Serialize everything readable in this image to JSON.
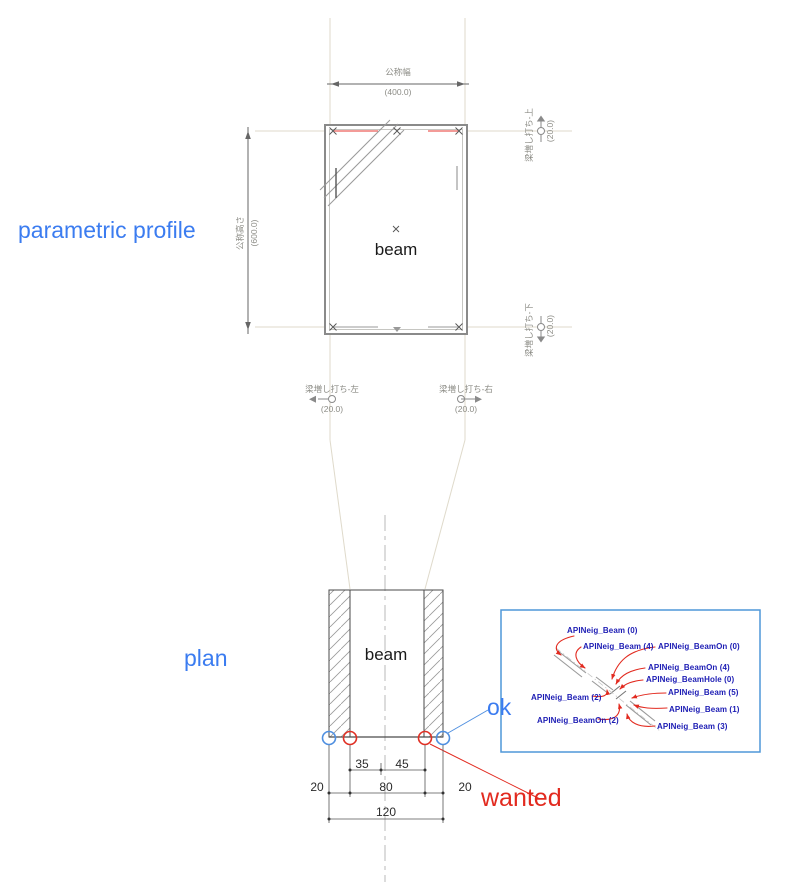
{
  "titles": {
    "parametric_profile": "parametric profile",
    "plan": "plan"
  },
  "annotations": {
    "ok": "ok",
    "wanted": "wanted"
  },
  "profile": {
    "beam_label": "beam",
    "dim_width_name": "公称幅",
    "dim_width_value": "(400.0)",
    "dim_height_name": "公称高さ",
    "dim_height_value": "(600.0)",
    "offsets": {
      "top": {
        "name": "梁増し打ち-上",
        "value": "(20.0)"
      },
      "bottom": {
        "name": "梁増し打ち-下",
        "value": "(20.0)"
      },
      "left": {
        "name": "梁増し打ち-左",
        "value": "(20.0)"
      },
      "right": {
        "name": "梁増し打ち-右",
        "value": "(20.0)"
      }
    }
  },
  "plan_view": {
    "beam_label": "beam",
    "dims": {
      "inner_left": "35",
      "inner_right": "45",
      "side_left": "20",
      "center": "80",
      "side_right": "20",
      "total": "120"
    }
  },
  "callout": {
    "labels": [
      "APINeig_Beam (0)",
      "APINeig_Beam (4)",
      "APINeig_BeamOn (0)",
      "APINeig_BeamOn (4)",
      "APINeig_BeamHole (0)",
      "APINeig_Beam (5)",
      "APINeig_Beam (2)",
      "APINeig_Beam (1)",
      "APINeig_BeamOn (2)",
      "APINeig_Beam (3)"
    ]
  },
  "colors": {
    "blue_label": "#3b7cf0",
    "red_label": "#e22a1f",
    "navy_api": "#1c1cb4",
    "callout_border": "#4f97d9",
    "ok_circle": "#4f8fe0",
    "wanted_circle": "#e03024",
    "profile_red_line": "#ef7a76"
  }
}
